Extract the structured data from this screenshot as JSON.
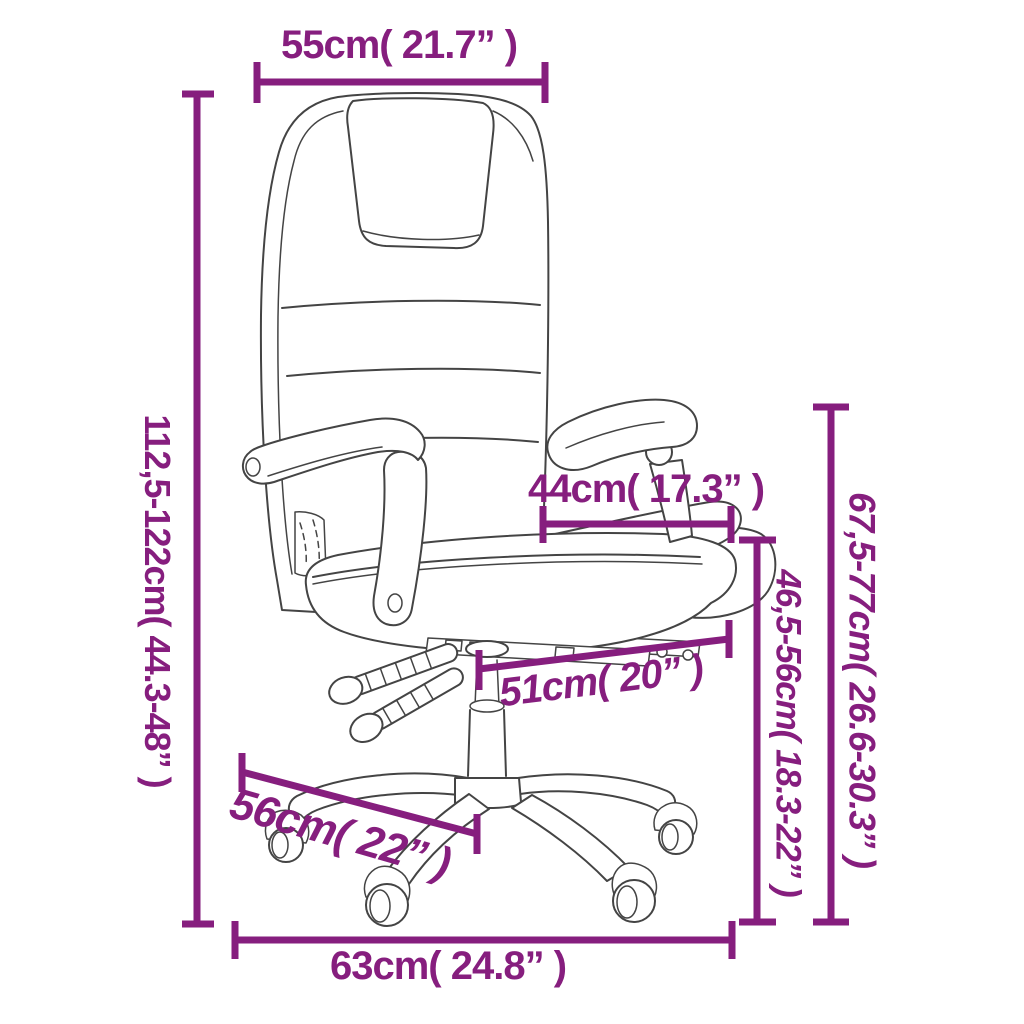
{
  "colors": {
    "dimension_accent": "#861e7e",
    "drawing_stroke": "#444444",
    "background": "#ffffff"
  },
  "drawing": {
    "name": "reclining-massage-office-chair-line-drawing"
  },
  "dimensions": {
    "top": "55cm( 21.7” )",
    "left": "112,5-122cm( 44.3-48” )",
    "mid_horizontal": "44cm( 17.3” )",
    "mid_diagonal": "51cm( 20” )",
    "right_inner": "46,5-56cm( 18.3-22” )",
    "right_outer": "67,5-77cm( 26.6-30.3” )",
    "base_diagonal": "56cm( 22” )",
    "base_bottom": "63cm( 24.8” )"
  }
}
